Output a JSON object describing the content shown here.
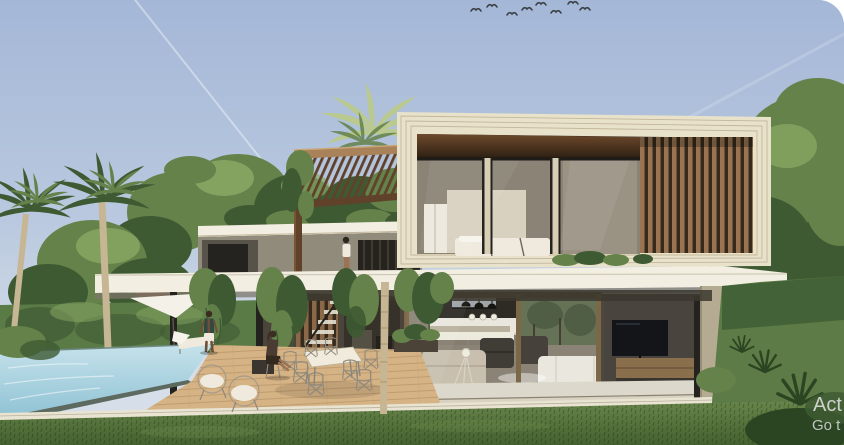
{
  "window": {
    "corner_radius_px": 26,
    "outside_background": "#ffffff"
  },
  "watermark": {
    "line1": "Act",
    "line2": "Go t"
  },
  "scene": {
    "kind": "3D architectural exterior render",
    "subject": "modern two-story tropical villa with cantilevered upper bedroom box, wood slat screens, pergola, green roof with hanging vines, open-plan living floor, swimming pool, wooden deck and garden",
    "birds_count": 8,
    "people": [
      "standing-man-by-pool",
      "sitting-woman-on-deck",
      "standing-woman-on-terrace"
    ],
    "labels": [
      "sky",
      "contrails",
      "birds-flock",
      "palm-trees",
      "background-trees",
      "hedge",
      "upper-floor-box",
      "bedroom-interior",
      "wood-slat-screen",
      "pergola",
      "roof-terrace",
      "hanging-vines",
      "floor-slab",
      "living-room",
      "kitchen",
      "dining-area",
      "tv-wall",
      "swimming-pool",
      "wood-deck",
      "outdoor-dining-set",
      "lounge-chairs",
      "sun-lounger",
      "shade-sail",
      "lawn",
      "garden-bushes",
      "activation-watermark"
    ]
  },
  "palette": {
    "sky_top": "#a4b7d7",
    "sky_mid": "#bac9df",
    "sky_low": "#d6dfe9",
    "contrail": "#ffffff",
    "bird": "#3a4046",
    "tree_dark": "#3e5a33",
    "tree_mid": "#648249",
    "tree_light": "#8cab66",
    "palm_light": "#b9c98f",
    "palm_trunk": "#c7b694",
    "hedge_green": "#5a7a46",
    "frame_cream": "#e9e2cb",
    "frame_line": "#bfb295",
    "wood_soffit": "#6e4a2c",
    "wood_soffit_dark": "#2b1e12",
    "slat_wood": "#9a7450",
    "slat_dark": "#362a1d",
    "pergola_wood": "#a98259",
    "pergola_dark": "#60412a",
    "concrete": "#918b7c",
    "concrete_dark": "#57534a",
    "slab_white": "#f2eee1",
    "interior_wall": "#8b8476",
    "interior_dark": "#4c4840",
    "glass_dark": "#242320",
    "bronze": "#7c6746",
    "kitchen_dark": "#2e2b25",
    "sofa_beige": "#c8bfae",
    "sofa_white": "#eae7de",
    "tv_black": "#131519",
    "wood_media": "#8a6f4d",
    "pool_light": "#c6e2eb",
    "pool_deep": "#8fc2d4",
    "deck_wood": "#d6b385",
    "deck_line": "#b08e63",
    "stone_edge": "#e9e3d2",
    "grass_light": "#6f8c50",
    "grass_mid": "#5d7b46",
    "grass_dark": "#44622f",
    "bush_dark": "#2b4523",
    "skin": "#9c7354",
    "skin_dark": "#6e4f38",
    "shirt_teal": "#2e4a41",
    "cloth_white": "#efeadd",
    "watermark": "#dadada"
  }
}
